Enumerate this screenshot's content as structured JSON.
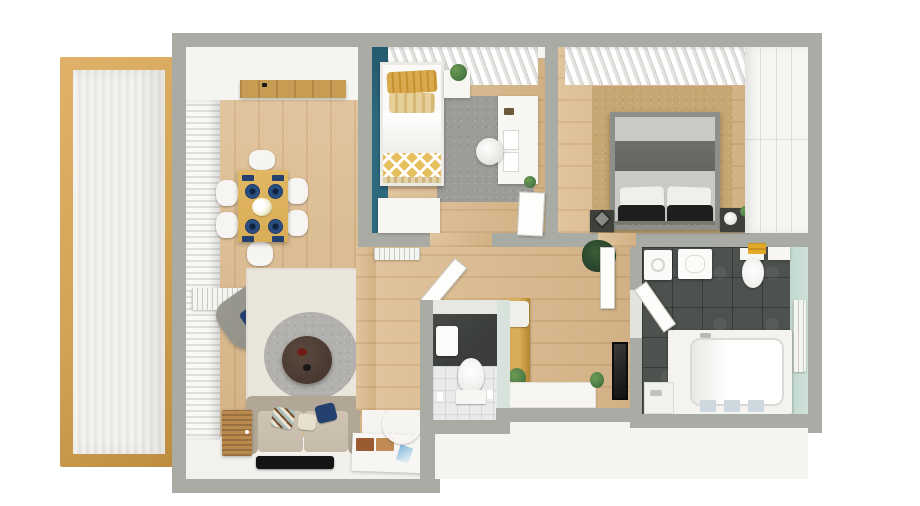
{
  "scene": {
    "type": "3d-floor-plan-render",
    "view": "top-down",
    "description": "Photorealistic rendered apartment floor plan, no visible text"
  },
  "colors": {
    "wall_gray": "#a9aca4",
    "wall_inner": "#f5f4f1",
    "floor_wood": "#dcba8c",
    "floor_wood_deep": "#c69d52",
    "balcony_frame": "#d2a355",
    "balcony_floor": "#f2f1ee",
    "teal_wall": "#2e6a7e",
    "mint_wall": "#cfe2da",
    "tile_dark": "#4e524e",
    "wc_dark_wall": "#3b3e3b",
    "rug_gray": "#9d9c99",
    "rug_cream": "#ebe6dc",
    "rug_tan": "#c6a672",
    "blanket_yellow": "#e6c05e",
    "pillow_mustard": "#d9a94e",
    "sofa_beige": "#c6bbaa",
    "sofa_back": "#b2a796",
    "armchair_gray": "#8d8c84",
    "navy": "#23406e",
    "table_wood": "#d9ad57",
    "rattan": "#b9894e",
    "coffee_table": "#483830",
    "bed_frame_gray": "#8c8f8a",
    "duvet_light": "#cac9c6",
    "throw_dark": "#65655f",
    "pillow_black": "#1e1e1e",
    "furniture_white": "#f7f6f3",
    "towel_yellow": "#e2a928",
    "plant_green": "#4e7d46",
    "plant_dark": "#26402b",
    "tv_black": "#141414",
    "mat_blue": "#cdd9de"
  },
  "rooms": [
    {
      "name": "balcony",
      "floor": "white decking with wood frame",
      "items": [
        "wood-frame"
      ]
    },
    {
      "name": "living-dining-room",
      "floor": "light oak planks",
      "items": [
        "window-blinds",
        "wall-shelf",
        "dining-table",
        "dining-chairs-x6",
        "navy-plates-x4",
        "napkins",
        "flower-centerpiece",
        "radiator",
        "armchair",
        "blue-cushion",
        "cream-area-rug",
        "round-gray-rug",
        "coffee-table",
        "sofa",
        "throw-pillows",
        "rattan-cabinet",
        "tv-screen",
        "media-console",
        "magazines",
        "decorative-wheel",
        "ladder-shelf"
      ]
    },
    {
      "name": "kids-bedroom",
      "floor": "light oak planks",
      "items": [
        "teal-accent-wall",
        "window-curtain",
        "single-bed",
        "mustard-pillows",
        "white-duvet",
        "chevron-blanket",
        "nightstand",
        "potted-plant",
        "gray-rug",
        "desk",
        "papers",
        "desk-chair",
        "dresser",
        "door-leaf"
      ]
    },
    {
      "name": "master-bedroom",
      "floor": "light oak planks",
      "items": [
        "window-curtain",
        "tan-rug",
        "double-bed",
        "gray-throw",
        "white-pillows",
        "black-pillows",
        "nightstand-left",
        "nightstand-right",
        "lamp",
        "potted-plant",
        "wardrobe"
      ]
    },
    {
      "name": "hallway",
      "floor": "light oak planks",
      "items": [
        "radiator",
        "coat-bench",
        "seat-cushion",
        "potted-plant",
        "dark-plant",
        "wall-mirror",
        "doormat",
        "small-plant",
        "door-leaf-master",
        "door-leaf-wc"
      ]
    },
    {
      "name": "wc",
      "floor": "white tile",
      "items": [
        "dark-accent-wall",
        "washbasin",
        "toilet",
        "bottles"
      ]
    },
    {
      "name": "bathroom",
      "floor": "dark slate tile",
      "items": [
        "washing-machine",
        "vanity-sink",
        "toilet",
        "yellow-towels",
        "shelf",
        "bathtub",
        "tub-faucet",
        "bath-mats-x3",
        "shower-tray",
        "mint-wall",
        "radiator",
        "door-leaf"
      ]
    }
  ]
}
